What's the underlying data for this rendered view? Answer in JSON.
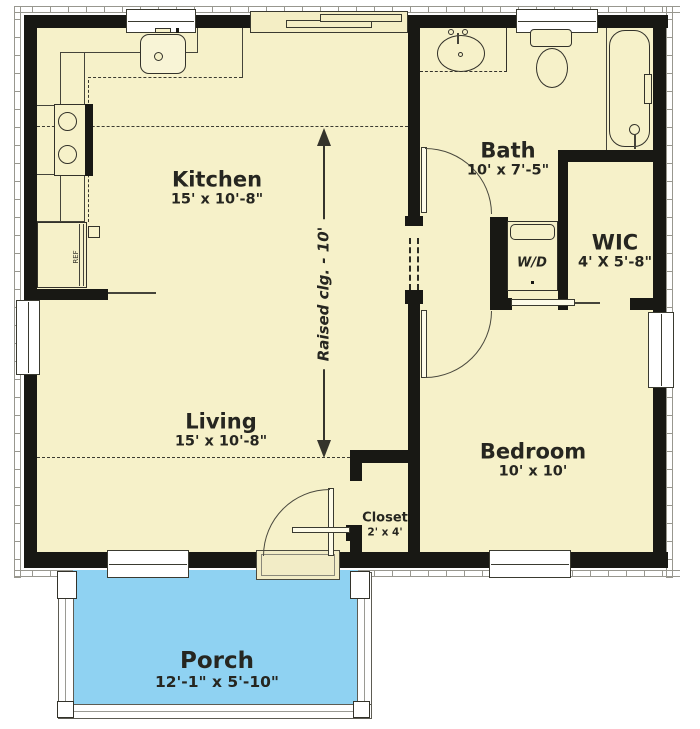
{
  "plan": {
    "rooms": {
      "kitchen": {
        "name": "Kitchen",
        "dims": "15' x 10'-8\""
      },
      "living": {
        "name": "Living",
        "dims": "15' x 10'-8\""
      },
      "bath": {
        "name": "Bath",
        "dims": "10' x 7'-5\""
      },
      "wic": {
        "name": "WIC",
        "dims": "4' X 5'-8\""
      },
      "bedroom": {
        "name": "Bedroom",
        "dims": "10' x 10'"
      },
      "closet": {
        "name": "Closet",
        "dims": "2' x 4'"
      },
      "porch": {
        "name": "Porch",
        "dims": "12'-1\" x 5'-10\""
      }
    },
    "fixtures": {
      "washer_dryer": "W/D",
      "refrigerator": "REF"
    },
    "annotations": {
      "raised_ceiling": "Raised clg. - 10'"
    },
    "colors": {
      "floor": "#f6f1c9",
      "porch_floor": "#8fd2f2",
      "wall": "#181814",
      "label_text": "#262620"
    }
  }
}
